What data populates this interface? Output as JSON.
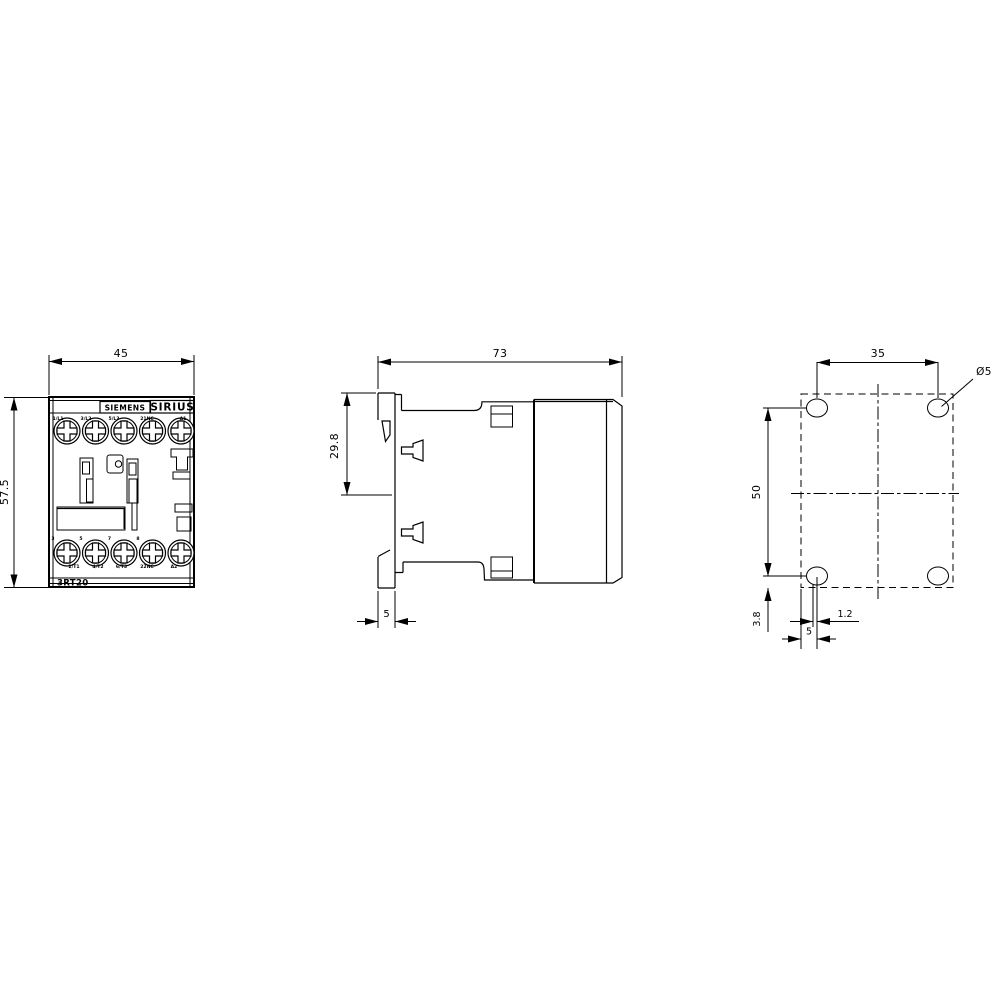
{
  "drawing": {
    "type": "dimensional-drawing",
    "views": {
      "front": {
        "brand": "SIEMENS",
        "series": "SIRIUS",
        "model": "3RT20",
        "dim_width": "45",
        "dim_height": "57.5",
        "terminals_top": [
          "1/L1",
          "3/L2",
          "5/L3",
          "21NC",
          "A1"
        ],
        "terminals_bottom": [
          "2/T1",
          "4/T2",
          "6/T3",
          "22NC",
          "A2"
        ],
        "screw_marks": [
          "3",
          "5",
          "7",
          "8"
        ]
      },
      "side": {
        "dim_depth": "73",
        "dim_rail_offset": "29.8",
        "dim_hook_width": "5"
      },
      "drill_plan": {
        "dim_hole_spacing_horizontal": "35",
        "dim_hole_spacing_vertical": "50",
        "dim_hole_diameter": "Ø5",
        "dim_edge_offset": "3.8",
        "dim_offset_small": "1.2",
        "dim_edge_to_hole": "5"
      }
    },
    "colors": {
      "line": "#000000",
      "background": "#ffffff"
    }
  }
}
